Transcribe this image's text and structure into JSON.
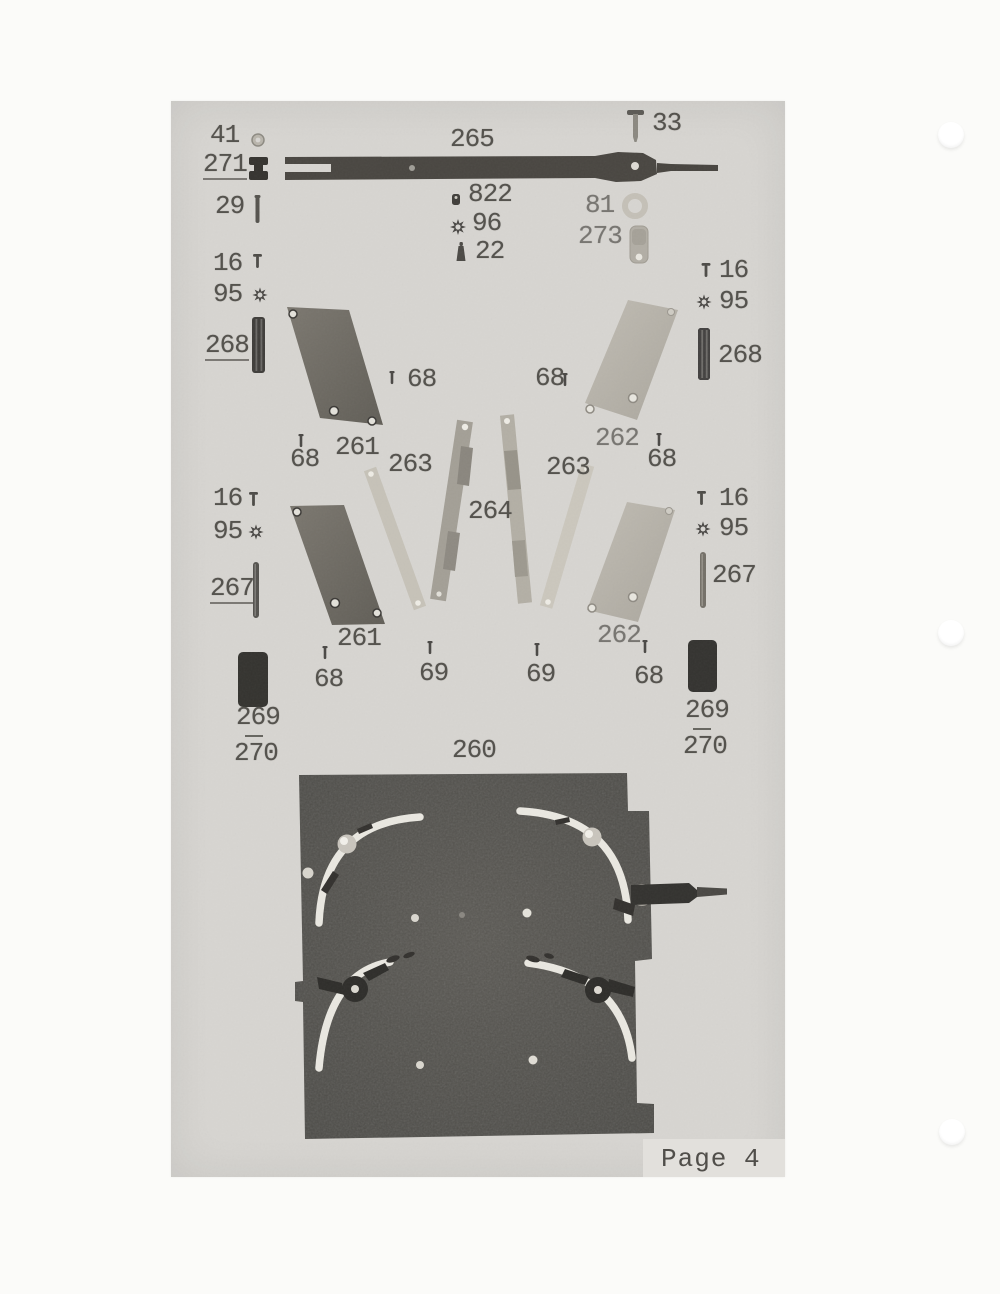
{
  "footer": {
    "page_label": "Page 4"
  },
  "parts": {
    "p41": "41",
    "p271": "271",
    "p265": "265",
    "p33": "33",
    "p29": "29",
    "p822": "822",
    "p96": "96",
    "p22": "22",
    "p81": "81",
    "p273": "273",
    "p16": "16",
    "p95": "95",
    "p268": "268",
    "p267": "267",
    "p261": "261",
    "p262": "262",
    "p263": "263",
    "p264": "264",
    "p68": "68",
    "p69": "69",
    "p269": "269",
    "p270": "270",
    "p260": "260"
  },
  "icons": [
    "hex-nut-icon",
    "grommet-icon",
    "pin-icon",
    "screw-icon",
    "bead-icon",
    "star-washer-icon",
    "ring-icon",
    "cylinder-icon",
    "t-screw-icon",
    "rod-icon",
    "rubber-block-icon",
    "lever-strip-icon"
  ],
  "colors": {
    "paper": "#fbfbf9",
    "scan_panel": "#d7d5d1",
    "label_ink": "#55534e",
    "photo_plate": "#52504c",
    "slot_white": "#eae8e1",
    "dark_part": "#45433f",
    "plate_dark": "#726e66",
    "plate_light": "#b8b4ab"
  }
}
